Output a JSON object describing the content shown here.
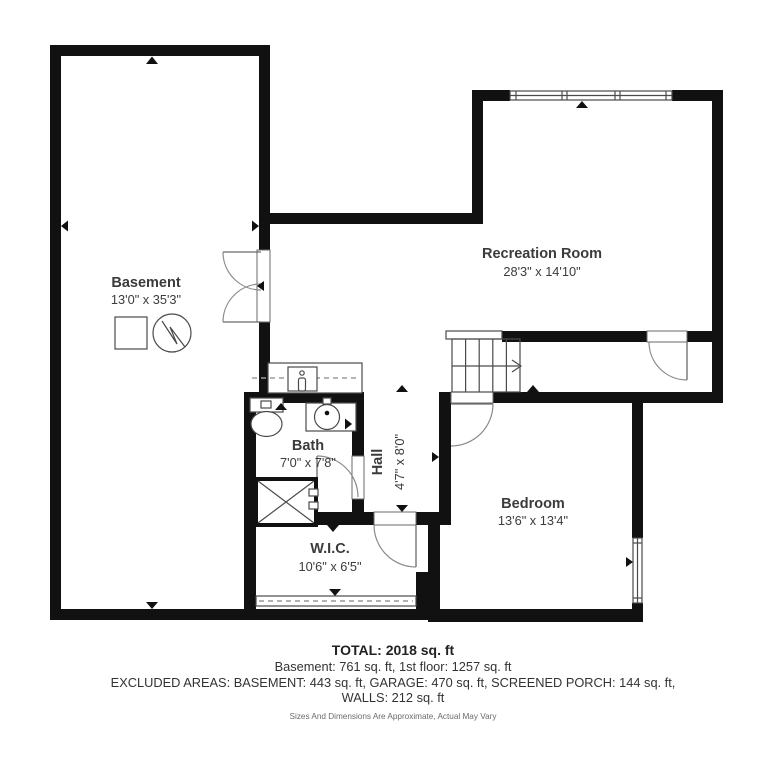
{
  "plan": {
    "title": "Basement floor plan",
    "rooms": {
      "basement": {
        "name": "Basement",
        "dims": "13'0\" x 35'3\""
      },
      "recreation": {
        "name": "Recreation Room",
        "dims": "28'3\" x 14'10\""
      },
      "bath": {
        "name": "Bath",
        "dims": "7'0\" x 7'8\""
      },
      "hall": {
        "name": "Hall",
        "dims": "4'7\" x 8'0\""
      },
      "bedroom": {
        "name": "Bedroom",
        "dims": "13'6\" x 13'4\""
      },
      "wic": {
        "name": "W.I.C.",
        "dims": "10'6\" x 6'5\""
      }
    },
    "footer": {
      "total": "TOTAL: 2018 sq. ft",
      "floors": "Basement: 761 sq. ft, 1st floor: 1257 sq. ft",
      "excluded": "EXCLUDED AREAS: BASEMENT: 443 sq. ft, GARAGE: 470 sq. ft, SCREENED PORCH: 144 sq. ft,",
      "walls": "WALLS: 212 sq. ft",
      "disclaimer": "Sizes And Dimensions Are Approximate, Actual May Vary"
    },
    "colors": {
      "wall": "#111111",
      "thin_line": "#4a4a4a",
      "door_arc": "#8a8a8a",
      "label_text": "#3b3b3b"
    },
    "icons": [
      "water-heater-icon",
      "sump-square-icon",
      "stairs-up-arrow-icon",
      "toilet-icon",
      "sink-icon",
      "laundry-sink-icon",
      "shower-icon"
    ]
  }
}
